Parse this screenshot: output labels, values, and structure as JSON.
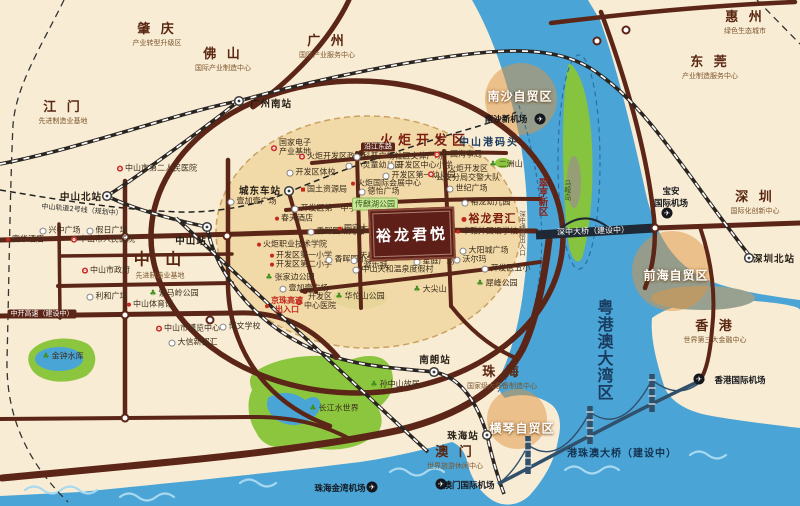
{
  "colors": {
    "land": "#f9ecd4",
    "water": "#4aa4d6",
    "waveLight": "#a8d9f0",
    "torchFill": "#f1d7a4",
    "road": "#5b2517",
    "rail": "#2a2521",
    "zoneOrange": "rgba(224,148,64,0.5)",
    "parkGreen": "#8cc63f",
    "lake": "#49a5d5",
    "maroon": "#7c1d10",
    "navy": "#1b3c61",
    "projectBox": "#5e1f18"
  },
  "project": {
    "name": "裕龙君悦"
  },
  "cities": [
    {
      "name": "肇 庆",
      "sub": "产业转型升级区",
      "x": 157,
      "y": 33
    },
    {
      "name": "佛 山",
      "sub": "国际产业制造中心",
      "x": 223,
      "y": 58
    },
    {
      "name": "广 州",
      "sub": "国际产业服务中心",
      "x": 327,
      "y": 45
    },
    {
      "name": "惠 州",
      "sub": "绿色生态城市",
      "x": 745,
      "y": 21
    },
    {
      "name": "东 莞",
      "sub": "产业制造服务中心",
      "x": 710,
      "y": 66
    },
    {
      "name": "江 门",
      "sub": "先进制造业基地",
      "x": 63,
      "y": 111
    },
    {
      "name": "中 山",
      "sub": "先进制造业基地",
      "x": 160,
      "y": 263,
      "big": true
    },
    {
      "name": "深 圳",
      "sub": "国际化创新中心",
      "x": 755,
      "y": 201
    },
    {
      "name": "香 港",
      "sub": "世界第三大金融中心",
      "x": 715,
      "y": 330
    },
    {
      "name": "珠 海",
      "sub": "国家级大装备制造中心",
      "x": 502,
      "y": 376
    },
    {
      "name": "澳 门",
      "sub": "世界旅游休闲中心",
      "x": 455,
      "y": 456
    }
  ],
  "zones": [
    {
      "name": "南沙自贸区",
      "x": 520,
      "y": 96
    },
    {
      "name": "前海自贸区",
      "x": 676,
      "y": 275
    },
    {
      "name": "横琴自贸区",
      "x": 522,
      "y": 428
    }
  ],
  "area_labels": [
    {
      "name": "火炬开发区",
      "x": 425,
      "y": 139,
      "cls": "torch"
    },
    {
      "name": "中山港码头",
      "x": 489,
      "y": 141,
      "cls": "port"
    },
    {
      "name": "粤港澳大湾区",
      "x": 604,
      "y": 350,
      "cls": "bay v"
    },
    {
      "name": "翠亨新区",
      "x": 542,
      "y": 197,
      "cls": "cuiheng v"
    },
    {
      "name": "马鞍岛",
      "x": 567,
      "y": 190,
      "cls": "island v"
    },
    {
      "name": "深中通道出入口",
      "x": 521,
      "y": 233,
      "cls": "exit v"
    },
    {
      "name": "港珠澳大桥（建设中）",
      "x": 622,
      "y": 452,
      "cls": "bridge-label"
    },
    {
      "name": "深中大桥（建设中）",
      "x": 593,
      "y": 231,
      "cls": "bridge-band-label"
    },
    {
      "name": "中开高速（建设中）",
      "x": 42,
      "y": 314,
      "cls": "road-label"
    },
    {
      "name": "沿江东路",
      "x": 378,
      "y": 147,
      "cls": "road-label"
    },
    {
      "name": "中山轨道2号线（规划中）",
      "x": 82,
      "y": 210,
      "cls": "metro-label",
      "rot": 5
    }
  ],
  "stations": [
    {
      "name": "广州南站",
      "tx": 271,
      "ty": 103,
      "ix": 239,
      "iy": 101
    },
    {
      "name": "中山北站",
      "tx": 81,
      "ty": 196,
      "ix": 107,
      "iy": 196
    },
    {
      "name": "中山站",
      "tx": 191,
      "ty": 240,
      "ix": 207,
      "iy": 227
    },
    {
      "name": "城东车站",
      "tx": 260,
      "ty": 190,
      "ix": 289,
      "iy": 191
    },
    {
      "name": "南朗站",
      "tx": 435,
      "ty": 359,
      "ix": 434,
      "iy": 372
    },
    {
      "name": "珠海站",
      "tx": 463,
      "ty": 435,
      "ix": 487,
      "iy": 435
    },
    {
      "name": "深圳北站",
      "tx": 774,
      "ty": 258,
      "ix": 749,
      "iy": 258
    }
  ],
  "airports": [
    {
      "name": "南沙新机场",
      "tx": 506,
      "ty": 119,
      "ix": 540,
      "iy": 119
    },
    {
      "name": "宝安国际机场",
      "tx": 671,
      "ty": 197,
      "ix": 667,
      "iy": 213,
      "lines": [
        "宝安",
        "国际机场"
      ]
    },
    {
      "name": "香港国际机场",
      "tx": 740,
      "ty": 380,
      "ix": 699,
      "iy": 379
    },
    {
      "name": "珠海金湾机场",
      "tx": 340,
      "ty": 488,
      "ix": 372,
      "iy": 487
    },
    {
      "name": "澳门国际机场",
      "tx": 469,
      "ty": 485,
      "ix": 441,
      "iy": 484
    }
  ],
  "pois": [
    {
      "name": "中山市第二人民医院",
      "x": 157,
      "y": 169,
      "t": "red"
    },
    {
      "name": "兴中广场",
      "x": 60,
      "y": 231,
      "t": "star"
    },
    {
      "name": "假日广场",
      "x": 107,
      "y": 231,
      "t": "star"
    },
    {
      "name": "富华酒店",
      "x": 25,
      "y": 240,
      "t": "dot"
    },
    {
      "name": "中山市人民医院",
      "x": 103,
      "y": 240,
      "t": "red"
    },
    {
      "name": "中山市政府",
      "x": 106,
      "y": 271,
      "t": "red"
    },
    {
      "name": "利和广场",
      "x": 107,
      "y": 297,
      "t": "star"
    },
    {
      "name": "紫马岭公园",
      "x": 174,
      "y": 294,
      "t": "green"
    },
    {
      "name": "中山体育馆",
      "x": 150,
      "y": 305,
      "t": "dot"
    },
    {
      "name": "中山市博览中心",
      "x": 188,
      "y": 329,
      "t": "red"
    },
    {
      "name": "博文学校",
      "x": 240,
      "y": 327,
      "t": "star"
    },
    {
      "name": "大信新都汇",
      "x": 193,
      "y": 343,
      "t": "star"
    },
    {
      "name": "金钟水库",
      "x": 63,
      "y": 357,
      "t": "green"
    },
    {
      "name": "孙中山故居",
      "x": 395,
      "y": 385,
      "t": "green"
    },
    {
      "name": "长江水世界",
      "x": 334,
      "y": 409,
      "t": "green"
    },
    {
      "name": "国家电子产业基地",
      "x": 291,
      "y": 148,
      "t": "red",
      "lines": [
        "国家电子",
        "产业基地"
      ]
    },
    {
      "name": "火炬开发区政府",
      "x": 331,
      "y": 157,
      "t": "red"
    },
    {
      "name": "开发区体校",
      "x": 311,
      "y": 173,
      "t": "star"
    },
    {
      "name": "国土资源局",
      "x": 324,
      "y": 190,
      "t": "sq"
    },
    {
      "name": "壹加壹广场",
      "x": 252,
      "y": 202,
      "t": "star"
    },
    {
      "name": "开发区第一中学",
      "x": 324,
      "y": 209,
      "t": "star"
    },
    {
      "name": "春天酒店",
      "x": 294,
      "y": 219,
      "t": "dot"
    },
    {
      "name": "香晖园幼儿园",
      "x": 336,
      "y": 232,
      "t": "star"
    },
    {
      "name": "国宾大酒店",
      "x": 361,
      "y": 229,
      "t": "dot"
    },
    {
      "name": "火炬职业技术学院",
      "x": 292,
      "y": 245,
      "t": "dot"
    },
    {
      "name": "开发区第一小学",
      "x": 301,
      "y": 256,
      "t": "dot"
    },
    {
      "name": "开发区第二小学",
      "x": 301,
      "y": 265,
      "t": "dot"
    },
    {
      "name": "张家边公园",
      "x": 290,
      "y": 278,
      "t": "green"
    },
    {
      "name": "壹加壹广场",
      "x": 304,
      "y": 289,
      "t": "star"
    },
    {
      "name": "开发区中心医院",
      "x": 316,
      "y": 302,
      "t": "red",
      "lines": [
        "开发区",
        "中心医院"
      ]
    },
    {
      "name": "京珠高速出入口",
      "x": 284,
      "y": 306,
      "t": "hw",
      "lines": [
        "京珠高速",
        "出入口"
      ]
    },
    {
      "name": "香晖园小学",
      "x": 350,
      "y": 260,
      "t": "star"
    },
    {
      "name": "天和缤纷游乐城",
      "x": 371,
      "y": 261,
      "t": "star",
      "lines": [
        "天和缤纷",
        "游乐城"
      ]
    },
    {
      "name": "中山天和温泉度假村",
      "x": 393,
      "y": 270,
      "t": "star"
    },
    {
      "name": "华佗山公园",
      "x": 360,
      "y": 297,
      "t": "green"
    },
    {
      "name": "大尖山",
      "x": 430,
      "y": 290,
      "t": "green"
    },
    {
      "name": "科普广场社区文体广场",
      "x": 398,
      "y": 157,
      "t": "star"
    },
    {
      "name": "小灵童幼儿园",
      "x": 374,
      "y": 166,
      "t": "star"
    },
    {
      "name": "开发区中心小学",
      "x": 420,
      "y": 166,
      "t": "star"
    },
    {
      "name": "开发区第一幼儿园",
      "x": 419,
      "y": 176,
      "t": "star"
    },
    {
      "name": "火炬国际会展中心",
      "x": 386,
      "y": 184,
      "t": "dot"
    },
    {
      "name": "德怡广场",
      "x": 379,
      "y": 192,
      "t": "star"
    },
    {
      "name": "传麒湖公园",
      "x": 375,
      "y": 204,
      "t": "badge"
    },
    {
      "name": "中国海事局",
      "x": 458,
      "y": 155,
      "t": "red"
    },
    {
      "name": "火炬开发区公安分局交警大队",
      "x": 464,
      "y": 174,
      "t": "red",
      "lines": [
        "火炬开发区",
        "公安分局交警大队"
      ]
    },
    {
      "name": "二洲山",
      "x": 506,
      "y": 165,
      "t": "green"
    },
    {
      "name": "世纪广场",
      "x": 467,
      "y": 189,
      "t": "star"
    },
    {
      "name": "裕龙幼儿园",
      "x": 486,
      "y": 203,
      "t": "star"
    },
    {
      "name": "裕龙君汇",
      "x": 489,
      "y": 219,
      "t": "sister"
    },
    {
      "name": "卓雅外国语学校",
      "x": 487,
      "y": 232,
      "t": "dot"
    },
    {
      "name": "星庭广场",
      "x": 434,
      "y": 262,
      "t": "star"
    },
    {
      "name": "大阳城广场",
      "x": 484,
      "y": 251,
      "t": "star"
    },
    {
      "name": "沃尔玛",
      "x": 470,
      "y": 260,
      "t": "star"
    },
    {
      "name": "开发区五小",
      "x": 506,
      "y": 269,
      "t": "star"
    },
    {
      "name": "犀峰公园",
      "x": 497,
      "y": 284,
      "t": "green"
    }
  ]
}
